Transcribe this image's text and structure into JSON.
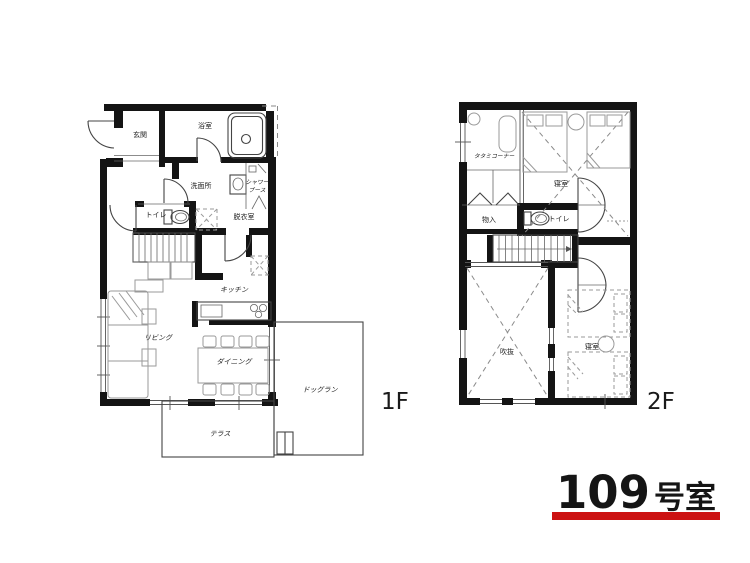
{
  "unit": {
    "number": "109",
    "suffix": "号室"
  },
  "floor1": {
    "tag": "1F",
    "genkan": "玄関",
    "bathroom": "浴室",
    "washroom": "洗面所",
    "shower_line1": "シャワー",
    "shower_line2": "ブース",
    "toilet": "トイレ",
    "dressing": "脱衣室",
    "kitchen": "キッチン",
    "living": "リビング",
    "dining": "ダイニング",
    "terrace": "テラス",
    "dogrun": "ドッグラン"
  },
  "floor2": {
    "tag": "2F",
    "tatami": "タタミコーナー",
    "bedroom1": "寝室",
    "closet": "物入",
    "toilet": "トイレ",
    "void": "吹抜",
    "bedroom2": "寝室"
  },
  "colors": {
    "wall": "#141414",
    "accent_red": "#cc1212",
    "thin_line": "#444444",
    "furniture": "#9a9a9a"
  }
}
